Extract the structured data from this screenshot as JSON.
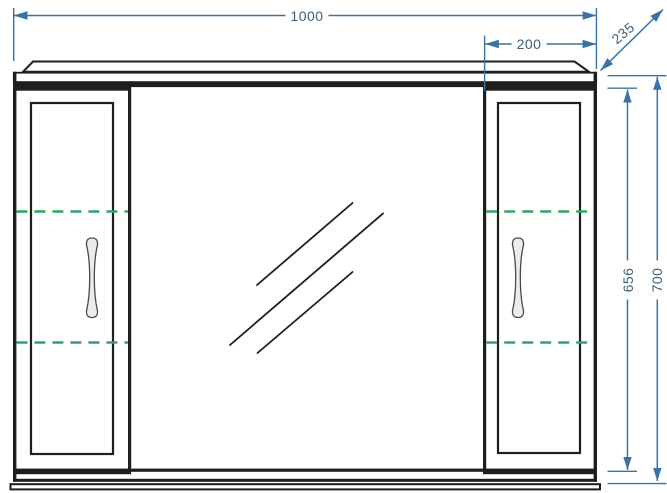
{
  "drawing": {
    "dimension_labels": {
      "total_width": "1000",
      "right_section_width": "200",
      "depth": "235",
      "inner_height": "656",
      "total_height": "700"
    },
    "colors": {
      "structure_line": "#1e1e1c",
      "dimension_line": "#3a72a5",
      "dimension_text": "#3e5f73",
      "shelf_dashed": "#2fa565",
      "background": "#ffffff"
    }
  }
}
